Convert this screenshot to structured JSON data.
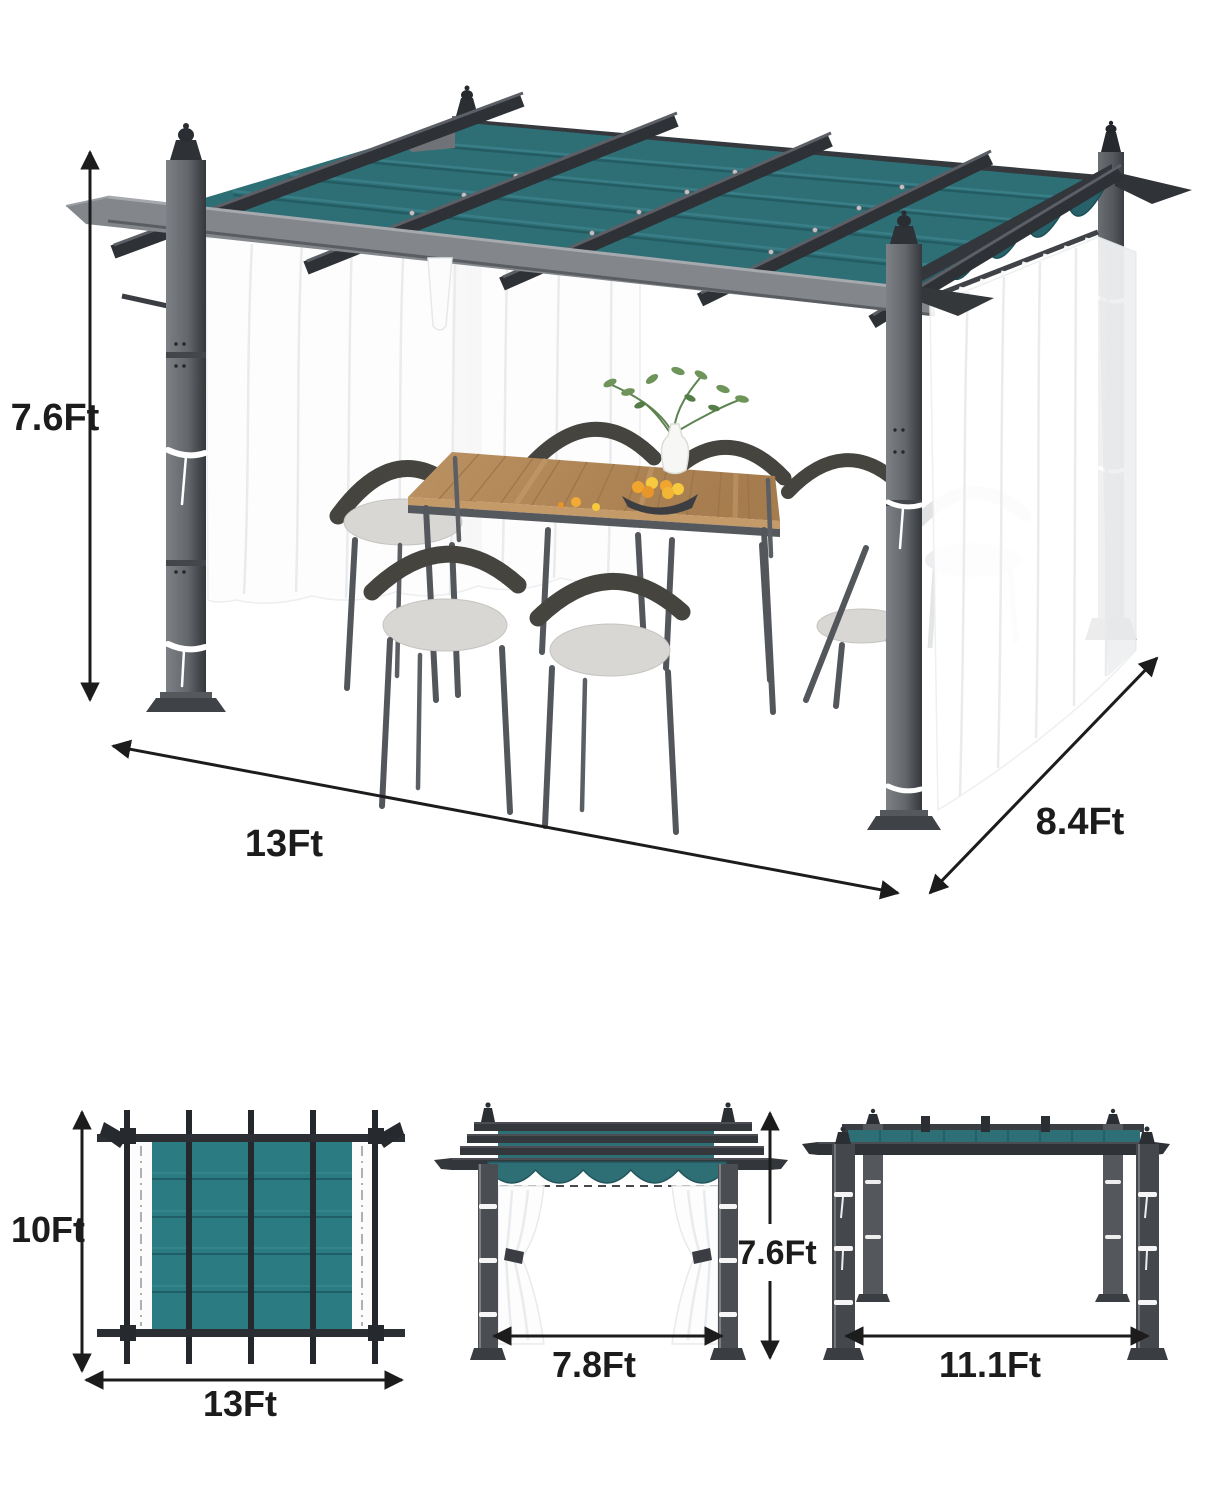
{
  "main_view": {
    "height_label": "7.6Ft",
    "width_label": "13Ft",
    "depth_label": "8.4Ft"
  },
  "top_view": {
    "depth_label": "10Ft",
    "width_label": "13Ft"
  },
  "front_view": {
    "width_label": "7.8Ft",
    "height_label": "7.6Ft"
  },
  "side_view": {
    "width_label": "11.1Ft"
  },
  "colors": {
    "canopy": "#2E6F76",
    "canopy_dark": "#276169",
    "canopy_top_view": "#2B7B82",
    "frame_dark": "#2F3237",
    "rail_gray": "#85888D",
    "curtain_white": "#FFFFFF",
    "wood": "#B68E60",
    "cushion": "#D9D7D3",
    "dimension_text": "#1C1C1C"
  }
}
